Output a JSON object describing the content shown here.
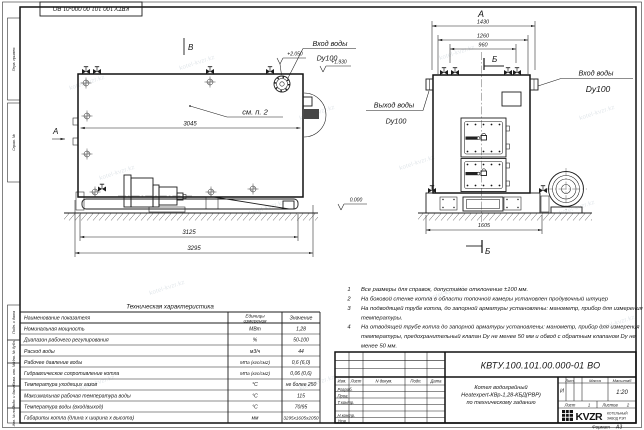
{
  "watermark": "kotel-kvzr.kz",
  "sheet": {
    "stamp_top": "КВТУ.100.101.00.000-01  ВО",
    "margin_labels": [
      "Перв. примен.",
      "Справ. №",
      "Подп. и дата",
      "Инв. № дубл.",
      "Взам. инв. №",
      "Подп. и дата",
      "Инв. № подл."
    ],
    "format_label": "Формат",
    "format_value": "А3"
  },
  "side_view": {
    "section_mark": "В",
    "view_arrow": "А",
    "elev_flange": "+2.050",
    "elev_nozzle": "+1.930",
    "elev_ground": "0.000",
    "see_note": "см. п. 2",
    "dim_width_inner": "3045",
    "dim_width_frame": "3125",
    "dim_width_total": "3295",
    "inlet_label": "Вход воды",
    "inlet_dn": "Dy100"
  },
  "front_view": {
    "view_title": "А",
    "dim_overall": "1430",
    "dim_mid": "1260",
    "dim_inner": "960",
    "dim_base": "1605",
    "section_top": "Б",
    "section_bottom": "Б",
    "inlet_label": "Вход воды",
    "inlet_dn": "Dy100",
    "outlet_label": "Выход воды",
    "outlet_dn": "Dy100"
  },
  "notes": {
    "items": [
      {
        "num": "1",
        "lines": [
          "Все размеры для справок, допустимое отклонение  ±100 мм."
        ]
      },
      {
        "num": "2",
        "lines": [
          "На боковой стенке котла в области топочной камеры установлен продувочный штуцер"
        ]
      },
      {
        "num": "3",
        "lines": [
          "На  подводящей трубе котла, до запорной арматуры установлены: манометр, прибор для измерения",
          "температуры."
        ]
      },
      {
        "num": "4",
        "lines": [
          "На отводящей трубе котла до запорной арматуры установлены: манометр, прибор для измерения",
          "температуры, предохранительный клапан  Dy не менее  50 мм и обвод с обратным клапаном  Dy не",
          "менее  50 мм."
        ]
      }
    ]
  },
  "spec_table": {
    "title": "Техническая характеристика",
    "headers": {
      "name": "Наименование показателя",
      "units_l1": "Единицы",
      "units_l2": "измерения",
      "value": "Значение"
    },
    "rows": [
      [
        "Номинальная мощность",
        "МВт",
        "1,28"
      ],
      [
        "Диапазон рабочего регулирования",
        "%",
        "50-100"
      ],
      [
        "Расход воды",
        "м3/ч",
        "44"
      ],
      [
        "Рабочее давление воды",
        "МПа (кгс/см2)",
        "0,6 (6,0)"
      ],
      [
        "Гидравлическое сопротивление котла",
        "МПа (кгс/см2)",
        "0,06 (0,6)"
      ],
      [
        "Температура уходящих газов",
        "°С",
        "не более 250"
      ],
      [
        "Максимальная рабочая температура воды",
        "°С",
        "115"
      ],
      [
        "Температура воды (вход/выход)",
        "°С",
        "70/95"
      ],
      [
        "Габариты котла (длина х ширина х высота)",
        "мм",
        "3295х1605х2050"
      ]
    ]
  },
  "title_block": {
    "doc_number": "КВТУ.100.101.00.000-01  ВО",
    "columns": [
      "Изм.",
      "Лист",
      "N докум.",
      "Подп.",
      "Дата"
    ],
    "roles": [
      "Разраб.",
      "Пров.",
      "Т.контр.",
      "Н.контр.",
      "Утв."
    ],
    "product_line1": "Котел водогрейный",
    "product_line2": "Heatexpert-КВр-1,28-КБД(РВР)",
    "product_line3": "по техническому заданию",
    "lit_label": "Лит.",
    "mass_label": "Масса",
    "scale_label": "Масштаб",
    "lit_value": "И",
    "scale_value": "1:20",
    "sheet_label": "Лист",
    "sheet_value": "1",
    "sheets_label": "Листов",
    "sheets_value": "2",
    "logo_text": "KVZR",
    "logo_sub1": "КОТЕЛЬНЫЙ",
    "logo_sub2": "ЗАВОД РЭП"
  }
}
